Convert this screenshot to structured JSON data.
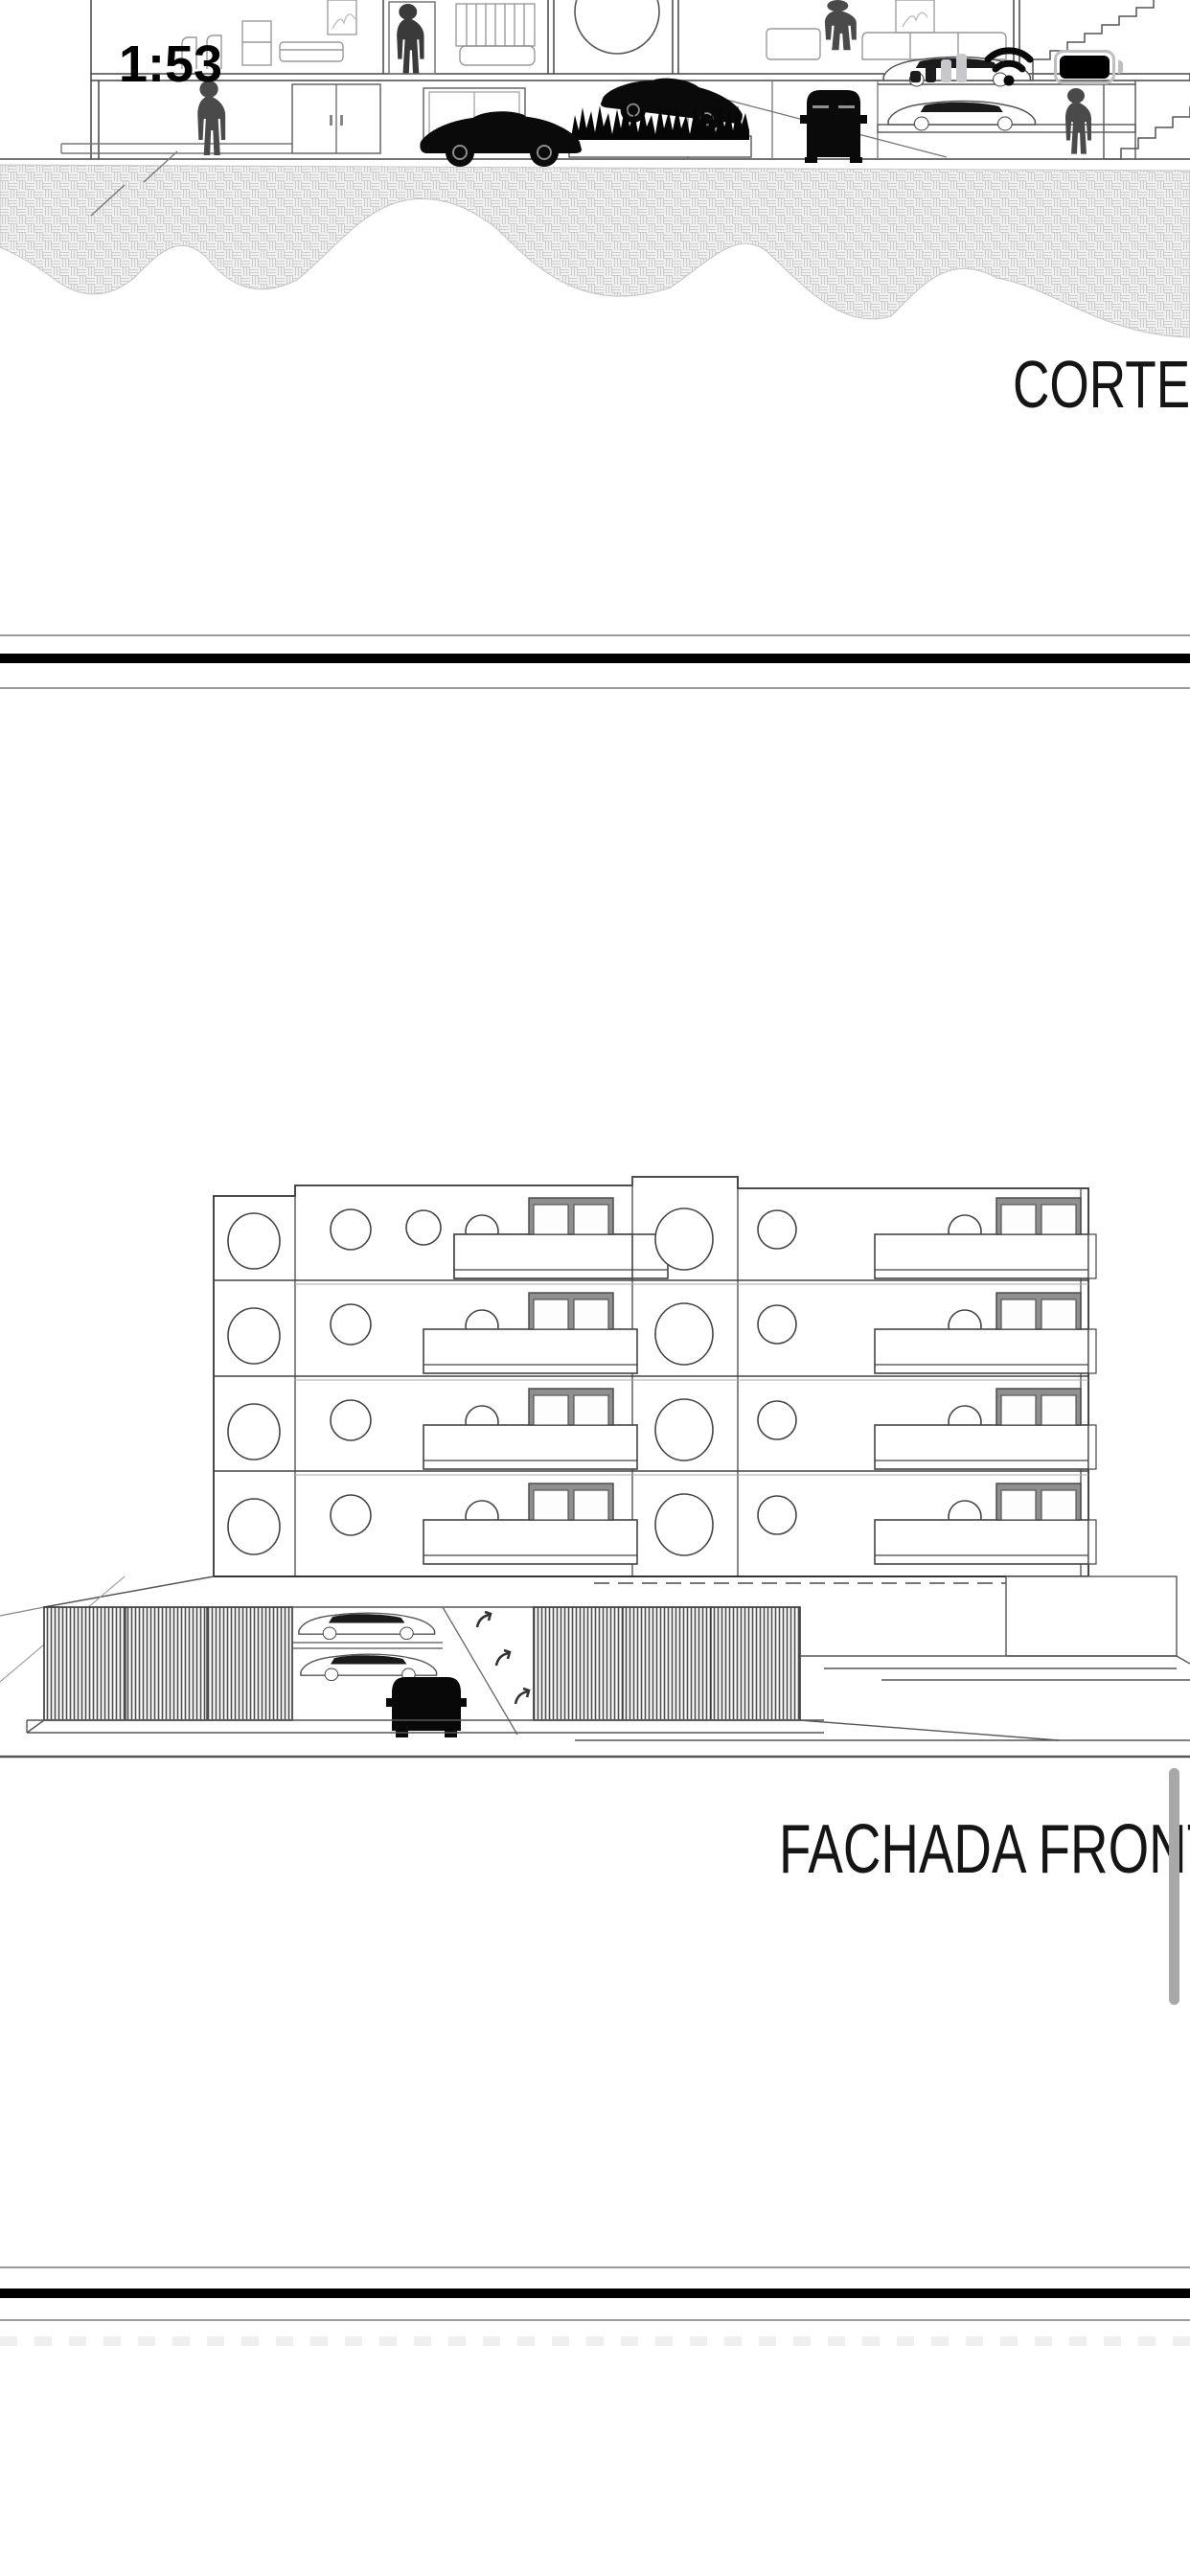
{
  "status_bar": {
    "time": "1:53",
    "signal_icon": "cellular-signal-2-of-4-bars",
    "wifi_icon": "wifi-full",
    "battery_icon": "battery-full"
  },
  "document": {
    "page1": {
      "label": "CORTE",
      "drawing": "building-section-drawing"
    },
    "page2": {
      "label": "FACHADA FRONT",
      "drawing": "front-facade-elevation-drawing"
    },
    "page3": {
      "drawing": "blank-page-top"
    }
  },
  "colors": {
    "paper": "#ffffff",
    "line": "#444444",
    "light_line": "#999999",
    "silhouette": "#4a4a4a",
    "car_black": "#0a0a0a",
    "hatch": "#cfcfcf",
    "divider_bar": "#000000",
    "page_edge": "#9a9a9a",
    "scrollbar": "#a8a8a8",
    "signal_dim": "#c8c8cc"
  }
}
